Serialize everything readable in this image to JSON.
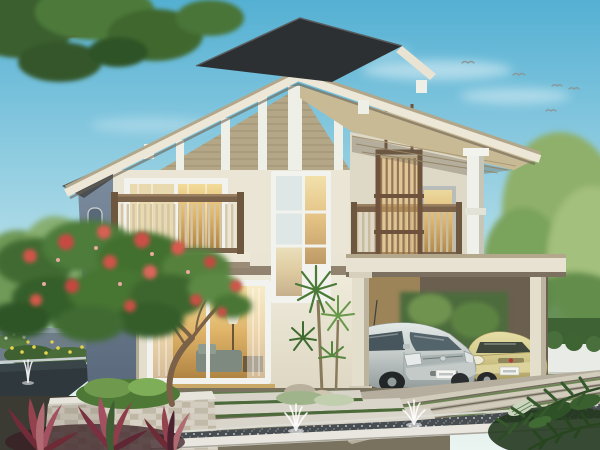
{
  "meta": {
    "type": "architectural-rendering",
    "subject": "Two-story modern tropical house exterior with attached carport and landscaped garden"
  },
  "scene": {
    "time_of_day": "day",
    "sky": "clear blue sky with thin clouds and distant birds",
    "description": "3D real-estate rendering: cream two-story house with khaki lap-siding gable, dark floating top roof plane, long eaves, two timber-railing balconies, hanging timber slat screen, tall white stairwell window, warm-lit ground-floor picture window, flat-roof carport sheltering a silver minivan and a gold compact car, frangipani tree with red blossoms over a stacked-stone planter, garden pond and long reflecting pool with fountain jets, stepping-slab path and striped concrete driveway, greenery all around.",
    "objects": [
      "sky",
      "clouds",
      "birds",
      "background trees",
      "overhanging branch",
      "house",
      "upper dark roof",
      "gable roof fascia",
      "lap siding gable",
      "left balcony",
      "right balcony",
      "timber slat screen",
      "stairwell window",
      "picture window",
      "carport",
      "silver minivan",
      "gold compact car",
      "frangipani tree",
      "stone planter",
      "garden pond",
      "reflecting pool",
      "fountain jets",
      "stepping path",
      "driveway",
      "red cordyline plants",
      "tropical leaves",
      "hedge",
      "garden wall"
    ],
    "house": {
      "floors": 2,
      "balconies": 2,
      "roof_style": "double gable with floating top plane",
      "carport_bays": 2
    },
    "cars": [
      {
        "name": "silver minivan",
        "body_color": "#c6cdcb"
      },
      {
        "name": "gold compact car",
        "body_color": "#d3c98b"
      }
    ],
    "birds_count": 5,
    "fountain_jets": 3
  },
  "palette": {
    "sky_top": "#54b0d3",
    "sky_mid": "#a8d8e6",
    "sky_horizon": "#ddeff1",
    "roof_dark": "#2c3033",
    "fascia_cream": "#ece7d6",
    "fascia_tan": "#b2a78b",
    "siding": "#b3a788",
    "wall_cream": "#eae5d4",
    "wall_shaded": "#ded8c6",
    "side_wall": "#6e7f91",
    "band_taupe": "#8b7d69",
    "wood_rail": "#7b624b",
    "baluster": "#d3c5a6",
    "glow_warm": "#dfb468",
    "window_white": "#f2f3ee",
    "column_white": "#eef0e9",
    "carport_shadow": "#6b5f50",
    "carport_warm": "#9c8458",
    "car_silver": "#c6cdcb",
    "car_gold": "#d3c98b",
    "glass": "#53646a",
    "foliage_dark": "#3f6a31",
    "foliage_mid": "#4d7c3a",
    "foliage_light": "#6f9a4e",
    "flower_red": "#cf544a",
    "trunk": "#7a6148",
    "stone": "#ccc5b7",
    "pond": "#2f383c",
    "pebble": "#474d50",
    "ledge": "#e8e6de",
    "concrete": "#cfcabb",
    "grass": "#5a7c46",
    "cordyline": "#94424e",
    "hedge": "#49703c",
    "fence": "#e9ebe6",
    "bird": "#8a989c"
  }
}
